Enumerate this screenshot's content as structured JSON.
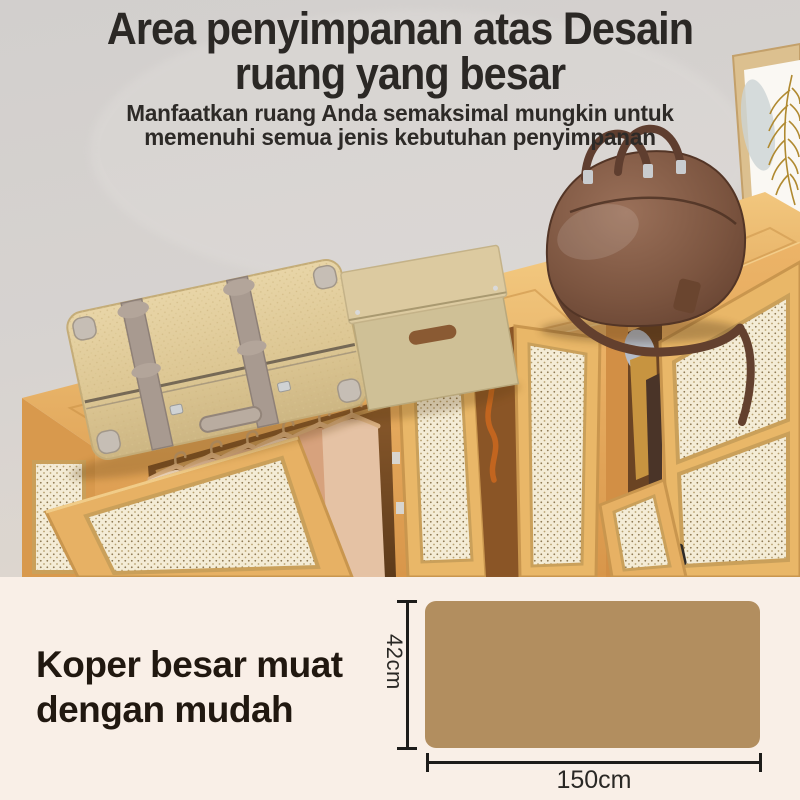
{
  "header": {
    "title_line1": "Area penyimpanan atas Desain",
    "title_line2": "ruang yang besar",
    "subtitle_line1": "Manfaatkan ruang Anda semaksimal mungkin untuk",
    "subtitle_line2": "memenuhi semua jenis kebutuhan penyimpanan",
    "text_color": "#2b2825"
  },
  "caption": {
    "line1": "Koper besar muat",
    "line2": "dengan mudah",
    "text_color": "#211810"
  },
  "dimension_diagram": {
    "height_label": "42cm",
    "width_label": "150cm",
    "panel_color": "#b28e5f",
    "line_color": "#1d1c1a",
    "label_color": "#2a2825"
  },
  "scene_colors": {
    "wall": "#d5d2cf",
    "bottom_background": "#f9efe7",
    "cabinet_wood": "#e8b269",
    "rattan_panel": "#f4ecd6",
    "suitcase": "#e3cf9f",
    "suitcase_strap": "#a89a90",
    "storage_box": "#d6c59c",
    "duffel_bag": "#7c5540",
    "hanging_clothes": "#e4c1a2",
    "plant": "#4c6f3a"
  }
}
